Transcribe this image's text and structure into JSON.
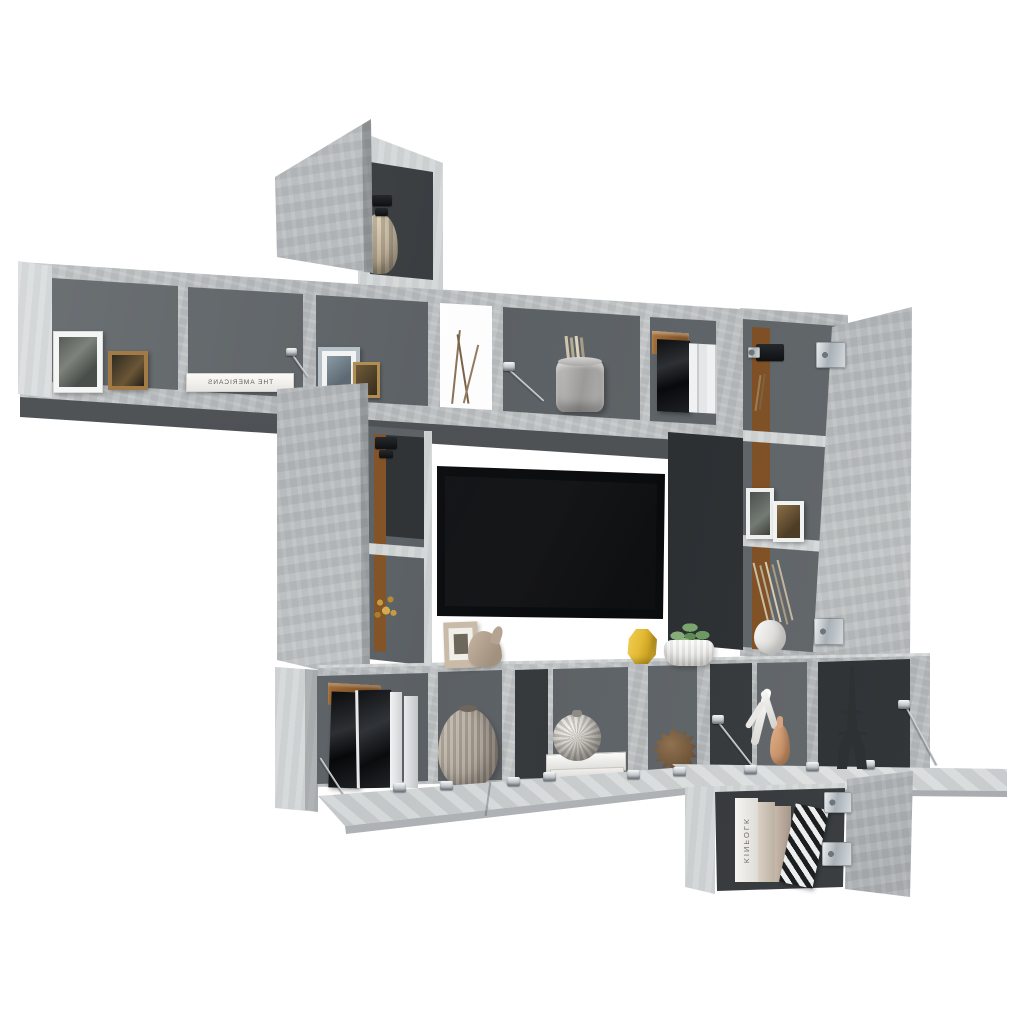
{
  "meta": {
    "title": "Wall-mounted TV cabinet set, concrete gray",
    "description": "Modular floating TV wall unit in concrete gray with open cube shelves, flip-down doors with metal stays, chrome hinges, a black flat-screen TV and decorative items, photographed on a white background."
  },
  "texts": {
    "book_flat_title": "THE AMERICANS",
    "book_spine_title": "KINFOLK"
  },
  "palette": {
    "bg": "#ffffff",
    "concrete": "#b9bdbf",
    "concreteHi": "#c9cdce",
    "concreteSide": "#d5d8d9",
    "interior": "#606568",
    "interiorDark": "#383c3f",
    "underside": "#4c5053",
    "wood": "#875829",
    "ledge": "#d2d5d6",
    "chrome": "#cfd5d9",
    "tv": "#131416",
    "accentYellow": "#e6c043",
    "succulent": "#7da371",
    "copper": "#9a6a38",
    "taupe": "#b0a79a",
    "peach": "#d8a47f",
    "bookWhite": "#f2f1ed",
    "silhouette": "#2e3134"
  }
}
